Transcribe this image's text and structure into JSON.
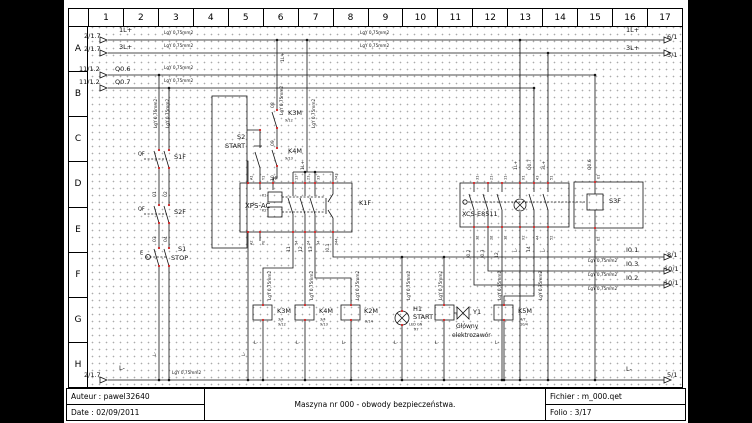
{
  "frame": {
    "columns": [
      "1",
      "2",
      "3",
      "4",
      "5",
      "6",
      "7",
      "8",
      "9",
      "10",
      "11",
      "12",
      "13",
      "14",
      "15",
      "16",
      "17"
    ],
    "rows": [
      "A",
      "B",
      "C",
      "D",
      "E",
      "F",
      "G",
      "H"
    ]
  },
  "title_block": {
    "auteur": "Auteur : pawel32640",
    "date": "Date : 02/09/2011",
    "title": "Maszyna nr 000 - obwody bezpieczeństwa.",
    "fichier": "Fichier : m_000.qet",
    "folio": "Folio : 3/17"
  },
  "colors": {
    "line": "#141414",
    "terminal_red": "#cc2222",
    "dot_grid": "#ababab",
    "page_bg": "#ffffff",
    "letterbox": "#000000"
  },
  "schematic": {
    "wire_spec": "LgY 0,75mm2",
    "labels": [
      {
        "t": "2/1.7",
        "x": 20,
        "y": 33
      },
      {
        "t": "1L+",
        "x": 55,
        "y": 27
      },
      {
        "t": "2/1.7",
        "x": 20,
        "y": 46
      },
      {
        "t": "3L+",
        "x": 55,
        "y": 44
      },
      {
        "t": "11/1.2",
        "x": 15,
        "y": 66
      },
      {
        "t": "Q0.6",
        "x": 51,
        "y": 66
      },
      {
        "t": "11/1.2",
        "x": 15,
        "y": 79
      },
      {
        "t": "Q0.7",
        "x": 51,
        "y": 79
      },
      {
        "t": "1L+",
        "x": 562,
        "y": 27
      },
      {
        "t": "6/1",
        "x": 603,
        "y": 34
      },
      {
        "t": "3L+",
        "x": 562,
        "y": 45
      },
      {
        "t": "5/1",
        "x": 603,
        "y": 52
      },
      {
        "t": "I0.1",
        "x": 562,
        "y": 247
      },
      {
        "t": "8/1",
        "x": 603,
        "y": 252
      },
      {
        "t": "I0.3",
        "x": 562,
        "y": 261
      },
      {
        "t": "10/1",
        "x": 600,
        "y": 266
      },
      {
        "t": "I0.2",
        "x": 562,
        "y": 275
      },
      {
        "t": "10/1",
        "x": 600,
        "y": 280
      },
      {
        "t": "L-",
        "x": 562,
        "y": 366
      },
      {
        "t": "5/1",
        "x": 603,
        "y": 372
      },
      {
        "t": "2/1.7",
        "x": 20,
        "y": 372
      },
      {
        "t": "L-",
        "x": 55,
        "y": 365
      },
      {
        "t": "LgY 0,75mm2",
        "x": 100,
        "y": 31,
        "s": 4.2
      },
      {
        "t": "LgY 0,75mm2",
        "x": 100,
        "y": 44,
        "s": 4.2
      },
      {
        "t": "LgY 0,75mm2",
        "x": 100,
        "y": 66,
        "s": 4.2
      },
      {
        "t": "LgY 0,75mm2",
        "x": 100,
        "y": 79,
        "s": 4.2
      },
      {
        "t": "LgY 0,75mm2",
        "x": 296,
        "y": 31,
        "s": 4.2
      },
      {
        "t": "LgY 0,75mm2",
        "x": 296,
        "y": 44,
        "s": 4.2
      },
      {
        "t": "LgY 0,75mm2",
        "x": 108,
        "y": 371,
        "s": 4.2
      },
      {
        "t": "LgY 0,75mm2",
        "x": 524,
        "y": 259,
        "s": 4.2
      },
      {
        "t": "LgY 0,75mm2",
        "x": 524,
        "y": 273,
        "s": 4.2
      },
      {
        "t": "LgY 0,75mm2",
        "x": 524,
        "y": 287,
        "s": 4.2
      },
      {
        "t": "LgY 0,75mm2",
        "x": 90,
        "y": 128,
        "s": 4.2,
        "r": 1
      },
      {
        "t": "LgY 0,75mm2",
        "x": 102,
        "y": 128,
        "s": 4.2,
        "r": 1
      },
      {
        "t": "LgY 0,75mm2",
        "x": 216,
        "y": 115,
        "s": 4.2,
        "r": 1
      },
      {
        "t": "LgY 0,75mm2",
        "x": 248,
        "y": 128,
        "s": 4.2,
        "r": 1
      },
      {
        "t": "LgY 0,75mm2",
        "x": 204,
        "y": 300,
        "s": 4.2,
        "r": 1
      },
      {
        "t": "LgY 0,75mm2",
        "x": 246,
        "y": 300,
        "s": 4.2,
        "r": 1
      },
      {
        "t": "LgY 0,75mm2",
        "x": 292,
        "y": 300,
        "s": 4.2,
        "r": 1
      },
      {
        "t": "LgY 0,75mm2",
        "x": 343,
        "y": 300,
        "s": 4.2,
        "r": 1
      },
      {
        "t": "LgY 0,75mm2",
        "x": 375,
        "y": 300,
        "s": 4.2,
        "r": 1
      },
      {
        "t": "LgY 0,75mm2",
        "x": 434,
        "y": 300,
        "s": 4.2,
        "r": 1
      },
      {
        "t": "LgY 0,75mm2",
        "x": 475,
        "y": 300,
        "s": 4.2,
        "r": 1
      },
      {
        "t": "01",
        "x": 89,
        "y": 197,
        "s": 4.5,
        "r": 1
      },
      {
        "t": "02",
        "x": 100,
        "y": 197,
        "s": 4.5,
        "r": 1
      },
      {
        "t": "03",
        "x": 89,
        "y": 242,
        "s": 4.5,
        "r": 1
      },
      {
        "t": "04",
        "x": 100,
        "y": 242,
        "s": 4.5,
        "r": 1
      },
      {
        "t": "08",
        "x": 207,
        "y": 108,
        "s": 4.5,
        "r": 1
      },
      {
        "t": "09",
        "x": 207,
        "y": 146,
        "s": 4.5,
        "r": 1
      },
      {
        "t": "10",
        "x": 207,
        "y": 181,
        "s": 4.5,
        "r": 1
      },
      {
        "t": "1L+",
        "x": 217,
        "y": 62,
        "s": 4.5,
        "r": 1
      },
      {
        "t": "1L+",
        "x": 237,
        "y": 170,
        "s": 4.5,
        "r": 1
      },
      {
        "t": "1L+",
        "x": 450,
        "y": 170,
        "s": 4.5,
        "r": 1
      },
      {
        "t": "Q0.7",
        "x": 464,
        "y": 170,
        "s": 4.5,
        "r": 1
      },
      {
        "t": "3L+",
        "x": 478,
        "y": 170,
        "s": 4.5,
        "r": 1
      },
      {
        "t": "Q0.6",
        "x": 524,
        "y": 170,
        "s": 4.5,
        "r": 1
      },
      {
        "t": "11",
        "x": 223,
        "y": 252,
        "s": 4.5,
        "r": 1
      },
      {
        "t": "12",
        "x": 235,
        "y": 252,
        "s": 4.5,
        "r": 1
      },
      {
        "t": "13",
        "x": 245,
        "y": 252,
        "s": 4.5,
        "r": 1
      },
      {
        "t": "I0.1",
        "x": 262,
        "y": 252,
        "s": 4.5,
        "r": 1
      },
      {
        "t": "I0.2",
        "x": 403,
        "y": 258,
        "s": 4.5,
        "r": 1
      },
      {
        "t": "I0.3",
        "x": 417,
        "y": 258,
        "s": 4.5,
        "r": 1
      },
      {
        "t": "12",
        "x": 431,
        "y": 258,
        "s": 4.5,
        "r": 1
      },
      {
        "t": "L-",
        "x": 450,
        "y": 252,
        "s": 4.5,
        "r": 1
      },
      {
        "t": "14",
        "x": 463,
        "y": 252,
        "s": 4.5,
        "r": 1
      },
      {
        "t": "L-",
        "x": 478,
        "y": 252,
        "s": 4.5,
        "r": 1
      },
      {
        "t": "L-",
        "x": 524,
        "y": 252,
        "s": 4.5,
        "r": 1
      },
      {
        "t": "L-",
        "x": 89,
        "y": 356,
        "s": 4.5,
        "r": 1
      },
      {
        "t": "L-",
        "x": 178,
        "y": 356,
        "s": 4.5,
        "r": 1
      },
      {
        "t": "L-",
        "x": 190,
        "y": 341,
        "s": 4.5
      },
      {
        "t": "L-",
        "x": 232,
        "y": 341,
        "s": 4.5
      },
      {
        "t": "L-",
        "x": 278,
        "y": 341,
        "s": 4.5
      },
      {
        "t": "L-",
        "x": 330,
        "y": 341,
        "s": 4.5
      },
      {
        "t": "L-",
        "x": 371,
        "y": 341,
        "s": 4.5
      },
      {
        "t": "L-",
        "x": 431,
        "y": 341,
        "s": 4.5
      },
      {
        "t": "S1F",
        "x": 110,
        "y": 154
      },
      {
        "t": "S2F",
        "x": 110,
        "y": 209
      },
      {
        "t": "S1",
        "x": 114,
        "y": 246
      },
      {
        "t": "STOP",
        "x": 107,
        "y": 255
      },
      {
        "t": "QF",
        "x": 74,
        "y": 152,
        "s": 5
      },
      {
        "t": "QF",
        "x": 74,
        "y": 207,
        "s": 5
      },
      {
        "t": "E",
        "x": 76,
        "y": 251,
        "s": 5
      },
      {
        "t": "S2",
        "x": 173,
        "y": 134
      },
      {
        "t": "START",
        "x": 161,
        "y": 143
      },
      {
        "t": "K3M",
        "x": 224,
        "y": 110
      },
      {
        "t": "K4M",
        "x": 224,
        "y": 148
      },
      {
        "t": "XPS-AC",
        "x": 181,
        "y": 203,
        "s": 7
      },
      {
        "t": "K1F",
        "x": 295,
        "y": 200
      },
      {
        "t": "K3M",
        "x": 213,
        "y": 308
      },
      {
        "t": "K4M",
        "x": 255,
        "y": 308
      },
      {
        "t": "K2M",
        "x": 300,
        "y": 308
      },
      {
        "t": "H1",
        "x": 349,
        "y": 306
      },
      {
        "t": "START",
        "x": 349,
        "y": 314
      },
      {
        "t": "Y1",
        "x": 409,
        "y": 309
      },
      {
        "t": "Główny",
        "x": 392,
        "y": 324,
        "s": 6
      },
      {
        "t": "elektrozawór",
        "x": 388,
        "y": 333,
        "s": 6
      },
      {
        "t": "K5M",
        "x": 454,
        "y": 308
      },
      {
        "t": "XCS-E8511",
        "x": 398,
        "y": 211
      },
      {
        "t": "S3F",
        "x": 545,
        "y": 198
      },
      {
        "t": "9/12",
        "x": 221,
        "y": 119,
        "s": 3.5
      },
      {
        "t": "9/13",
        "x": 221,
        "y": 157,
        "s": 3.5
      },
      {
        "t": "3/4",
        "x": 214,
        "y": 318,
        "s": 3.5
      },
      {
        "t": "9/12",
        "x": 214,
        "y": 323,
        "s": 3.5
      },
      {
        "t": "3/4",
        "x": 256,
        "y": 318,
        "s": 3.5
      },
      {
        "t": "9/13",
        "x": 256,
        "y": 323,
        "s": 3.5
      },
      {
        "t": "9/14",
        "x": 301,
        "y": 320,
        "s": 3.5
      },
      {
        "t": "LED GN",
        "x": 345,
        "y": 323,
        "s": 3.5
      },
      {
        "t": "X7",
        "x": 350,
        "y": 328,
        "s": 3.5
      },
      {
        "t": "4/7",
        "x": 456,
        "y": 318,
        "s": 3.5
      },
      {
        "t": "10/4",
        "x": 456,
        "y": 323,
        "s": 3.5
      },
      {
        "t": "A1",
        "x": 186,
        "y": 180,
        "s": 3.5,
        "r": 1
      },
      {
        "t": "Y1",
        "x": 198,
        "y": 180,
        "s": 3.5,
        "r": 1
      },
      {
        "t": "Y2",
        "x": 211,
        "y": 180,
        "s": 3.5,
        "r": 1
      },
      {
        "t": "13",
        "x": 231,
        "y": 180,
        "s": 3.5,
        "r": 1
      },
      {
        "t": "23",
        "x": 243,
        "y": 180,
        "s": 3.5,
        "r": 1
      },
      {
        "t": "33",
        "x": 253,
        "y": 180,
        "s": 3.5,
        "r": 1
      },
      {
        "t": "Y43",
        "x": 271,
        "y": 180,
        "s": 3.5,
        "r": 1
      },
      {
        "t": "A2",
        "x": 186,
        "y": 245,
        "s": 3.5,
        "r": 1
      },
      {
        "t": "PE",
        "x": 198,
        "y": 245,
        "s": 3.5,
        "r": 1
      },
      {
        "t": "14",
        "x": 231,
        "y": 245,
        "s": 3.5,
        "r": 1
      },
      {
        "t": "24",
        "x": 243,
        "y": 245,
        "s": 3.5,
        "r": 1
      },
      {
        "t": "34",
        "x": 253,
        "y": 245,
        "s": 3.5,
        "r": 1
      },
      {
        "t": "Y44",
        "x": 271,
        "y": 245,
        "s": 3.5,
        "r": 1
      },
      {
        "t": "K1",
        "x": 198,
        "y": 194,
        "s": 3.5
      },
      {
        "t": "K2",
        "x": 198,
        "y": 209,
        "s": 3.5
      },
      {
        "t": "31",
        "x": 412,
        "y": 180,
        "s": 3.5,
        "r": 1
      },
      {
        "t": "21",
        "x": 426,
        "y": 180,
        "s": 3.5,
        "r": 1
      },
      {
        "t": "11",
        "x": 440,
        "y": 180,
        "s": 3.5,
        "r": 1
      },
      {
        "t": "X1",
        "x": 458,
        "y": 180,
        "s": 3.5,
        "r": 1
      },
      {
        "t": "43",
        "x": 472,
        "y": 180,
        "s": 3.5,
        "r": 1
      },
      {
        "t": "51",
        "x": 486,
        "y": 180,
        "s": 3.5,
        "r": 1
      },
      {
        "t": "E1",
        "x": 533,
        "y": 179,
        "s": 3.5,
        "r": 1
      },
      {
        "t": "32",
        "x": 412,
        "y": 240,
        "s": 3.5,
        "r": 1
      },
      {
        "t": "22",
        "x": 426,
        "y": 240,
        "s": 3.5,
        "r": 1
      },
      {
        "t": "12",
        "x": 440,
        "y": 240,
        "s": 3.5,
        "r": 1
      },
      {
        "t": "X2",
        "x": 458,
        "y": 240,
        "s": 3.5,
        "r": 1
      },
      {
        "t": "44",
        "x": 472,
        "y": 240,
        "s": 3.5,
        "r": 1
      },
      {
        "t": "52",
        "x": 486,
        "y": 240,
        "s": 3.5,
        "r": 1
      },
      {
        "t": "E2",
        "x": 533,
        "y": 241,
        "s": 3.5,
        "r": 1
      }
    ]
  }
}
